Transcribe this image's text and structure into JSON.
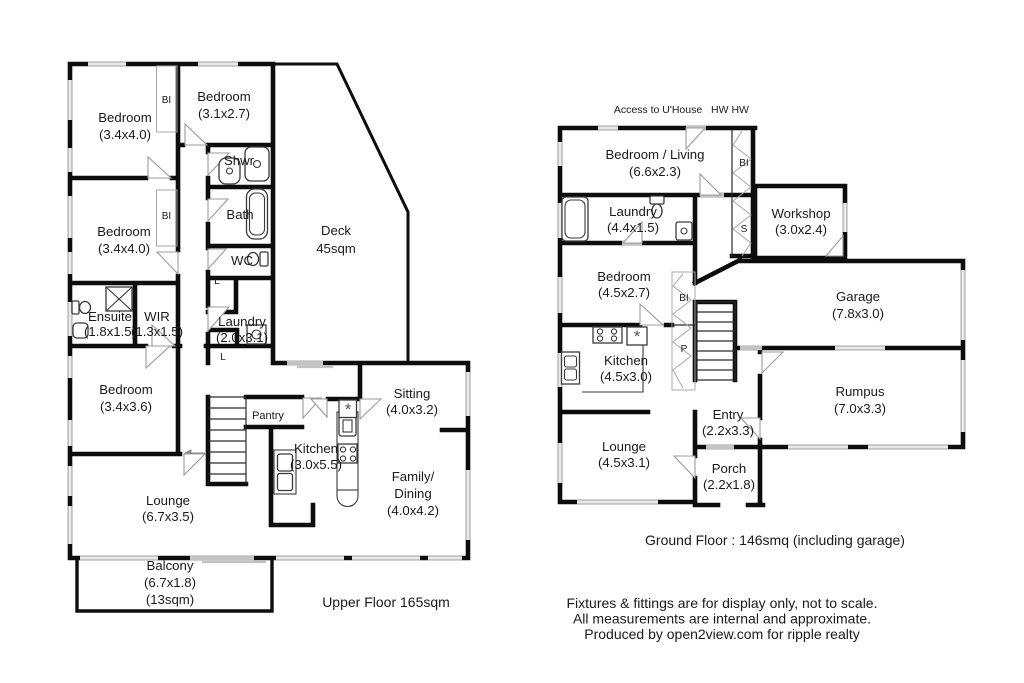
{
  "colors": {
    "wall": "#0d0d0d",
    "window": "#c3c3c3",
    "door_mark": "#9b9b9b",
    "text": "#1a1a1a"
  },
  "icons": {
    "heater": "*"
  },
  "upper": {
    "caption": "Upper Floor 165sqm",
    "bedroom1": {
      "name": "Bedroom",
      "size": "(3.4x4.0)"
    },
    "bedroom2": {
      "name": "Bedroom",
      "size": "(3.1x2.7)"
    },
    "bedroom3": {
      "name": "Bedroom",
      "size": "(3.4x4.0)"
    },
    "bedroom4": {
      "name": "Bedroom",
      "size": "(3.4x3.6)"
    },
    "shower": "Shwr",
    "bath": "Bath",
    "wc": "WC",
    "linen1": "L",
    "linen2": "L",
    "bi1": "BI",
    "bi2": "BI",
    "ensuite": {
      "name": "Ensuite",
      "size": "(1.8x1.5)"
    },
    "wir": {
      "name": "WIR",
      "size": "(1.3x1.5)"
    },
    "laundry": {
      "name": "Laundry",
      "size": "(2.0x3.1)"
    },
    "deck": {
      "name": "Deck",
      "size": "45sqm"
    },
    "pantry": "Pantry",
    "kitchen": {
      "name": "Kitchen",
      "size": "(3.0x5.5)"
    },
    "sitting": {
      "name": "Sitting",
      "size": "(4.0x3.2)"
    },
    "family": {
      "name": "Family/",
      "name2": "Dining",
      "size": "(4.0x4.2)"
    },
    "lounge": {
      "name": "Lounge",
      "size": "(6.7x3.5)"
    },
    "balcony": {
      "name": "Balcony",
      "size": "(6.7x1.8)",
      "area": "(13sqm)"
    }
  },
  "ground": {
    "caption": "Ground Floor : 146smq (including garage)",
    "access": "Access to U'House",
    "hw": "HW HW",
    "bedroom_living": {
      "name": "Bedroom / Living",
      "size": "(6.6x2.3)"
    },
    "laundry": {
      "name": "Laundry",
      "size": "(4.4x1.5)"
    },
    "workshop": {
      "name": "Workshop",
      "size": "(3.0x2.4)"
    },
    "bedroom": {
      "name": "Bedroom",
      "size": "(4.5x2.7)"
    },
    "garage": {
      "name": "Garage",
      "size": "(7.8x3.0)"
    },
    "kitchen": {
      "name": "Kitchen",
      "size": "(4.5x3.0)"
    },
    "rumpus": {
      "name": "Rumpus",
      "size": "(7.0x3.3)"
    },
    "entry": {
      "name": "Entry",
      "size": "(2.2x3.3)"
    },
    "lounge": {
      "name": "Lounge",
      "size": "(4.5x3.1)"
    },
    "porch": {
      "name": "Porch",
      "size": "(2.2x1.8)"
    },
    "bi1": "BI",
    "bi2": "BI",
    "s": "S",
    "p": "P"
  },
  "footer": {
    "line1": "Fixtures & fittings are for display only, not to scale.",
    "line2": "All measurements are internal and approximate.",
    "line3": "Produced by open2view.com for ripple realty"
  }
}
